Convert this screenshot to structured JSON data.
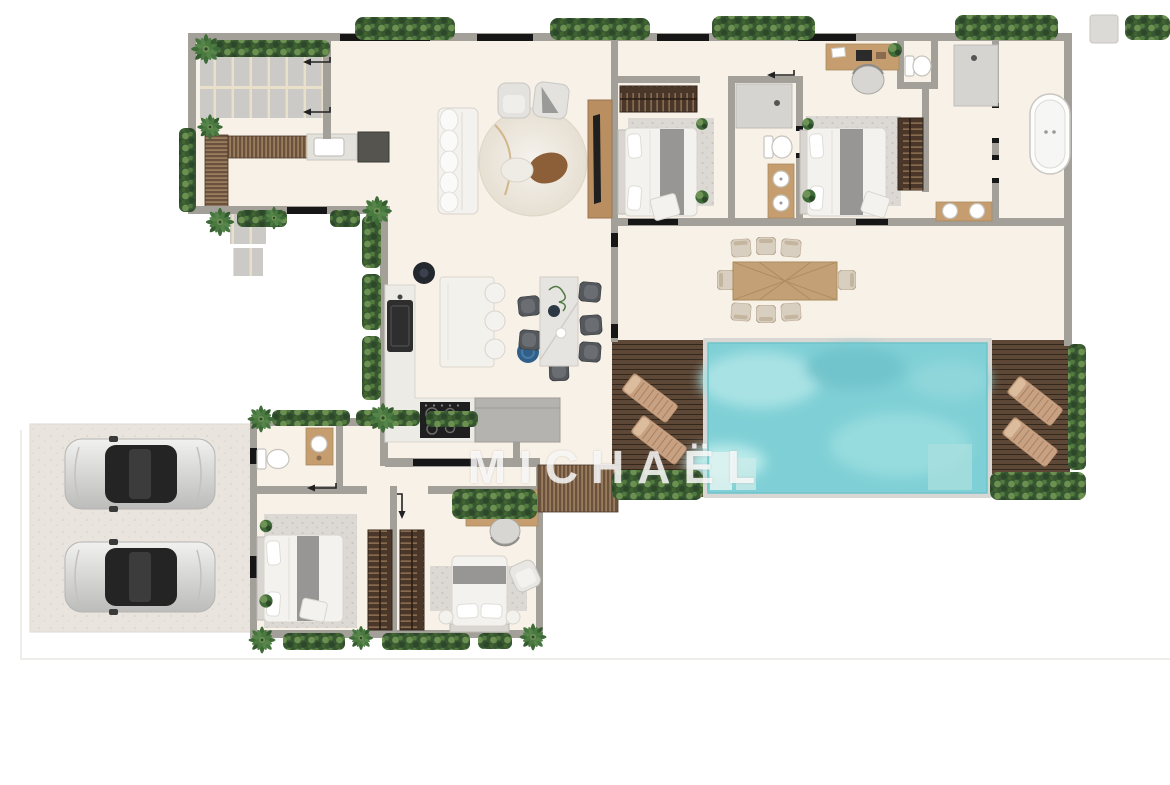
{
  "watermark": {
    "text": "MICHAËL"
  },
  "palette": {
    "wall": "#a3a09a",
    "floor": "#f8f1e7",
    "garage_slab": "#e9e5de",
    "paver": "#cbcac6",
    "paver_joint": "#eadfc8",
    "deck_wood": "#5d4736",
    "bench_wood": "#6b523d",
    "wardrobe_wood": "#4a372a",
    "furniture_wood": "#c59d6e",
    "hedge_dark": "#375733",
    "hedge_light": "#6c9050",
    "pool_water": "#7fd0d6",
    "pool_rim": "#d9d7d3",
    "white_furniture": "#f4f2ee",
    "gray_furniture": "#b5b3af",
    "appliance_dark": "#1f1f1f",
    "runner_gray": "#8e8e8c",
    "lounger_tan": "#c8a183",
    "accent_blue": "#306089",
    "rug_speckle": "#dcd9d4",
    "shower_gray": "#d6d4d0",
    "glass_black": "#161616",
    "marble_table": "#e6e4e0",
    "watermark": "rgba(255,255,255,0.8)"
  },
  "legend": {
    "rooms": [
      "entry-terrace",
      "living-room",
      "kitchen",
      "indoor-dining",
      "bedroom-1",
      "bedroom-2",
      "shared-bathroom",
      "wc",
      "master-bathroom",
      "bathtub-room",
      "outdoor-dining-terrace",
      "pool-deck-left",
      "swimming-pool",
      "pool-deck-right",
      "garage",
      "powder-room",
      "bedroom-3",
      "bedroom-4-office"
    ],
    "objects": [
      "sofa",
      "round-rug",
      "armchair",
      "tv-console",
      "kitchen-island",
      "bar-stool",
      "dining-table",
      "outdoor-dining-table",
      "sun-lounger",
      "bathtub",
      "shower",
      "toilet",
      "vanity-sink",
      "wardrobe",
      "double-bed",
      "desk",
      "car",
      "palm-tree",
      "hedge",
      "wood-bench",
      "bbq-grill",
      "outdoor-sink",
      "paver-patio",
      "pool-steps"
    ]
  },
  "counts": {
    "cars": 2,
    "sun_loungers": 4,
    "beds": 4,
    "bar_stools": 3
  }
}
